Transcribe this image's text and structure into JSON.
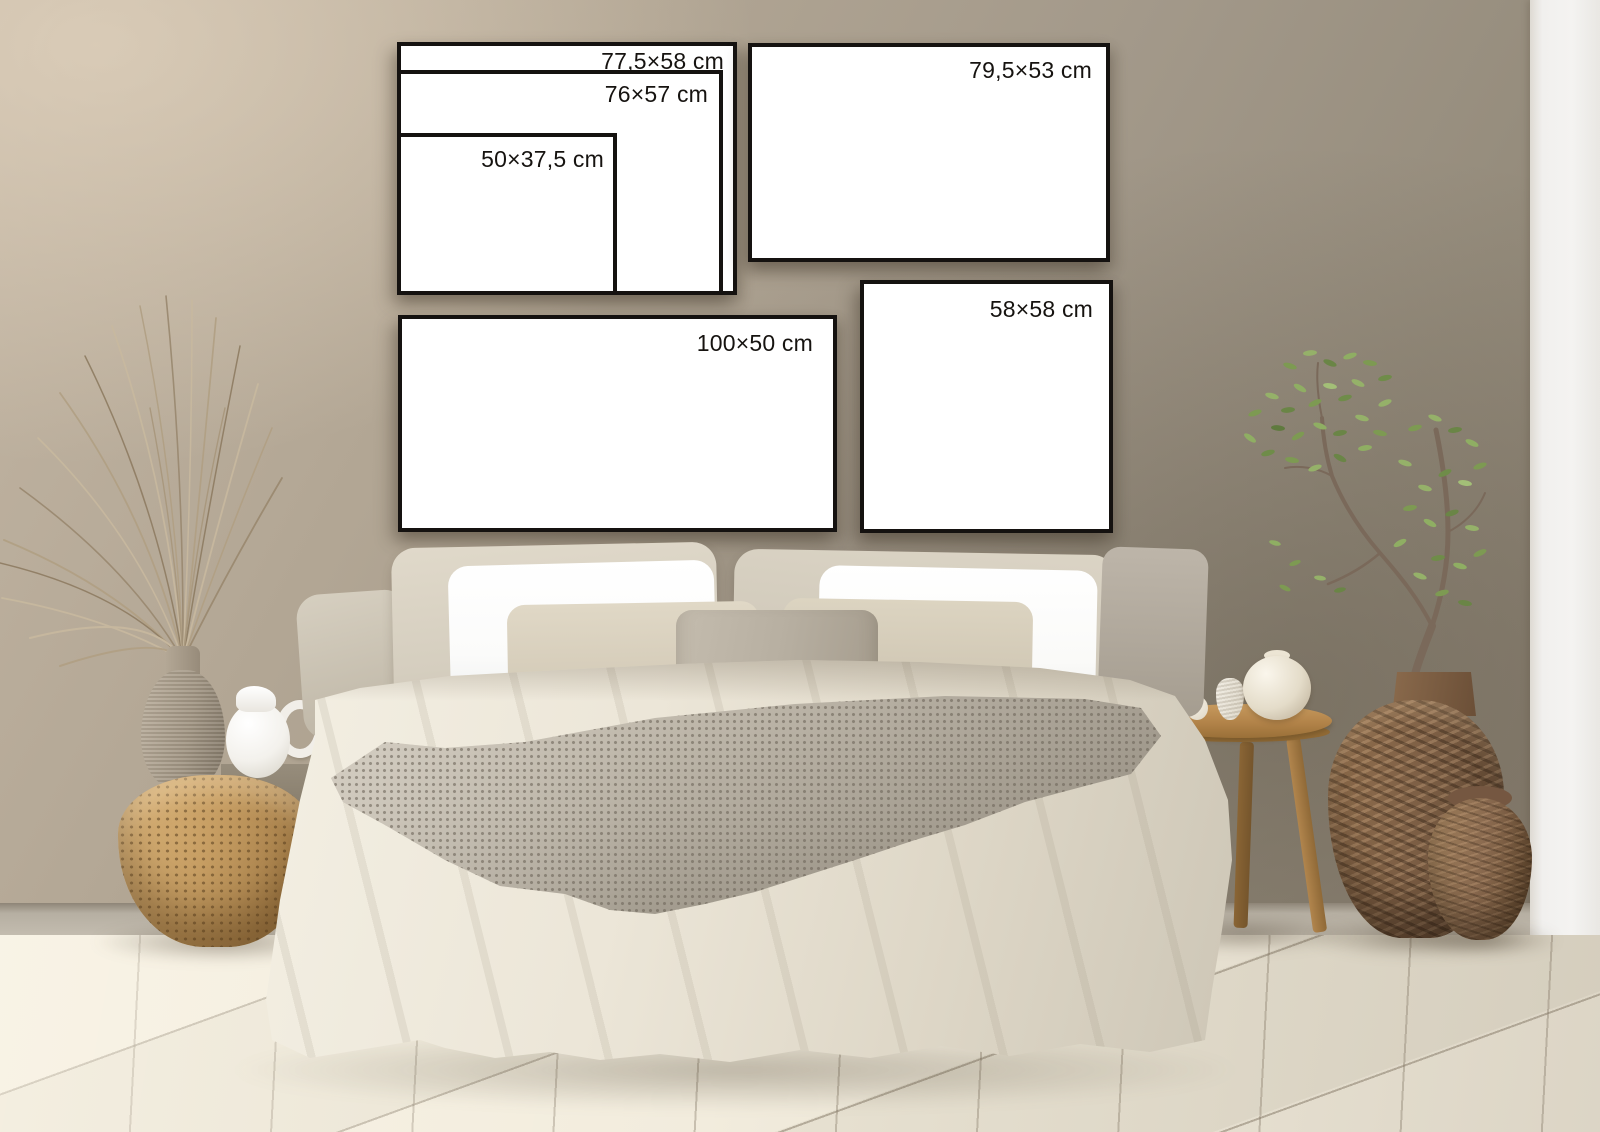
{
  "frames": {
    "f77": {
      "label": "77,5×58 cm"
    },
    "f76": {
      "label": "76×57 cm"
    },
    "f50": {
      "label": "50×37,5 cm"
    },
    "f79": {
      "label": "79,5×53 cm"
    },
    "f58": {
      "label": "58×58 cm"
    },
    "f100": {
      "label": "100×50 cm"
    }
  },
  "colors": {
    "wall": "#a89e8e",
    "wall_light": "#c2b5a3",
    "wall_dark": "#8b8172",
    "side_wall_white": "#f1f0ee",
    "floor": "#efe9db",
    "floor_seam": "#8c8070",
    "frame_fill": "#ffffff",
    "frame_border": "#151210",
    "label_text": "#161310",
    "duvet": "#e7e1d2",
    "pillow_linen": "#d7d0c1",
    "pillow_white": "#fcfcfb",
    "cushion_taupe": "#b7afa1",
    "knit_throw": "#b4ada0",
    "rattan_basket": "#c79e63",
    "stool_wood": "#b28349",
    "woven_vase": "#7d5f45",
    "clay_pot": "#8a6a4f",
    "plant_green": "#7d9a52",
    "dried_grass": "#c8b99f",
    "ceramic_vase": "#a29684",
    "jug_white": "#fbfaf8"
  }
}
